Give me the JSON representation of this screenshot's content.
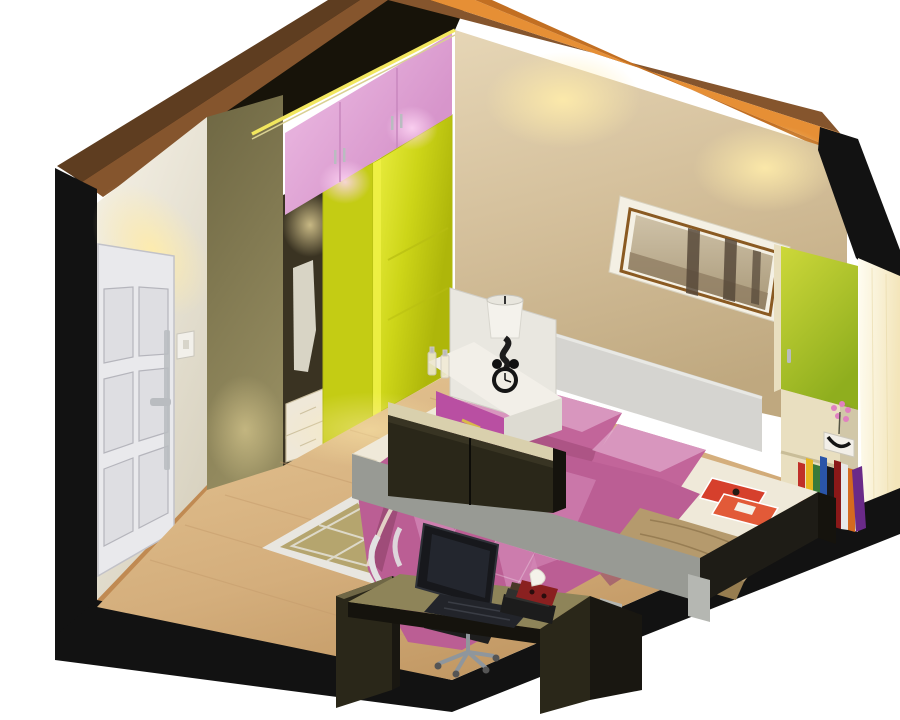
{
  "scene": {
    "title": "3D isometric cutaway render of a small bedroom",
    "description": "Bird's-eye isometric render of a bedroom: white entry door on the left wall, pink-and-green wardrobe along the left-back wall, tan back wall with a sepia framed picture, double bed with pink quilted bedding, white nightstand with lamp and alarm clock, green shelf unit with books, dark desk with laptop and office chair on a light wood floor.",
    "objects": [
      {
        "name": "entry-door",
        "description": "white six-panel door with chrome handle"
      },
      {
        "name": "wardrobe",
        "description": "sliding-door wardrobe, pink upper cabinets, yellow-green doors, open bay with drawers and hanging clothes"
      },
      {
        "name": "bed",
        "description": "double bed with gray headboard, pink pillows and quilted pink duvet, tan blanket and red magazines at the foot"
      },
      {
        "name": "nightstand",
        "description": "white nightstand with magenta drawer, table lamp, twin-bell alarm clock, perfume bottles"
      },
      {
        "name": "picture-frame",
        "description": "white frame with gold mat and sepia forest photograph"
      },
      {
        "name": "shelf-unit",
        "description": "green-door cabinet with open shelves, flower vase and colorful books"
      },
      {
        "name": "desk",
        "description": "dark desk with laptop, book stack, tissue box and office chair"
      },
      {
        "name": "area-rug",
        "description": "khaki rug with white diamond lattice border"
      },
      {
        "name": "floating-wall-cabinet",
        "description": "dark wall-hung cabinet over the bed side"
      }
    ]
  },
  "colors": {
    "outer_black": "#121212",
    "ceiling_dark": "#171309",
    "beam_dark_brown": "#5e3d20",
    "beam_mid_brown": "#85552d",
    "beam_orange": "#e68f35",
    "beam_orange_dark": "#c26f22",
    "rim_light_yellow": "#f2e75e",
    "rim_light_soft": "#d9d093",
    "wall_white_light": "#f6f2e7",
    "wall_white_dark": "#d8d2c0",
    "baseboard_wood": "#c08a52",
    "door_white": "#e9e9ec",
    "door_panel": "#dedee2",
    "door_line": "#b5b5bc",
    "switch_white": "#f2f0ea",
    "column_olive": "#958c60",
    "column_olive_dark": "#6e6743",
    "cabinet_pink": "#d795cb",
    "cabinet_pink_light": "#efc0e6",
    "cabinet_pink_line": "#c887be",
    "wardrobe_green_light": "#eef145",
    "wardrobe_green": "#cdd518",
    "wardrobe_green_dark": "#aeb60a",
    "wardrobe_green_mid": "#c4cc14",
    "wardrobe_interior": "#3a3322",
    "drawer_white": "#efe8d8",
    "drawer_line": "#cbbfa0",
    "shirt_white": "#e6e2d4",
    "wall_tan_light": "#e6d6b6",
    "wall_tan": "#d2bd98",
    "wall_tan_dark": "#bfa87f",
    "light_warm": "#ffecaa",
    "light_pink": "#ffd7f5",
    "frame_white": "#f4f0e4",
    "frame_gold": "#8a5a22",
    "photo_sky": "#cfc2a8",
    "photo_sepia": "#a89878",
    "photo_dark": "#57493a",
    "photo_ground": "#8d7b60",
    "glow_white": "#fffdf2",
    "glow_yellow": "#f3e5ba",
    "unit_green_light": "#cdd83a",
    "unit_green_dark": "#8fae1e",
    "unit_cream": "#e9dfc0",
    "unit_shadow": "#8a7f5e",
    "vase_white": "#f2efe8",
    "flower_pink": "#e080c0",
    "floor_wood_light": "#e6c694",
    "floor_wood": "#d4ae7c",
    "floor_wood_dark": "#bf9560",
    "plank_line": "#c59c6c",
    "rug_border_white": "#e8e6e0",
    "rug_khaki": "#b2a167",
    "headboard_gray": "#d5d4d0",
    "headboard_edge": "#e8e8e4",
    "mattress_white": "#efe9d9",
    "sheet_shadow": "#d8d0ba",
    "pillow_pink": "#c2659a",
    "pillow_pink_light": "#dc9fc4",
    "pillow_pink_dark": "#9e4a78",
    "duvet_pink": "#bb5e94",
    "duvet_light": "#d389b8",
    "duvet_dark": "#93456e",
    "blanket_tan": "#b59a6d",
    "blanket_tan_dark": "#977d50",
    "magazine_red": "#d6402c",
    "magazine_red2": "#e25a38",
    "footboard_black": "#1e1c16",
    "bedbase_gray": "#989a94",
    "leg_gray": "#b5b7b2",
    "nightstand_white": "#f2efe8",
    "nightstand_side": "#dddbd2",
    "nightstand_back": "#e9e7e0",
    "nightstand_magenta": "#b94fa2",
    "handle_gold": "#d8b84a",
    "lamp_shade": "#f4f2ec",
    "lamp_black": "#1c1c1c",
    "clock_face": "#f0ede4",
    "cab_top_cream": "#d9d0ad",
    "desk_top_olive": "#8e8459",
    "desk_top_sliver": "#6f6746",
    "desk_dark": "#2a2719",
    "desk_darker": "#191711",
    "desk_edge": "#15130d",
    "laptop_black": "#17181c",
    "laptop_base": "#22242a",
    "stack_black": "#1c1c1c",
    "stack_gray": "#30302e",
    "stack_brown": "#4a3828",
    "tissue_red": "#8a2020",
    "tissue_white": "#f4f2ea",
    "chrome": "#b9bcc0",
    "chair_white": "#e2e2e2",
    "chair_metal": "#8f969c",
    "chair_seat": "#1e1e1e"
  },
  "bookshelf": {
    "book_colors": [
      "#c03028",
      "#e8b820",
      "#3a7a3a",
      "#2a55a8",
      "#181818",
      "#8a1818",
      "#e8e8e8",
      "#d46a1f",
      "#6a2a88"
    ]
  }
}
